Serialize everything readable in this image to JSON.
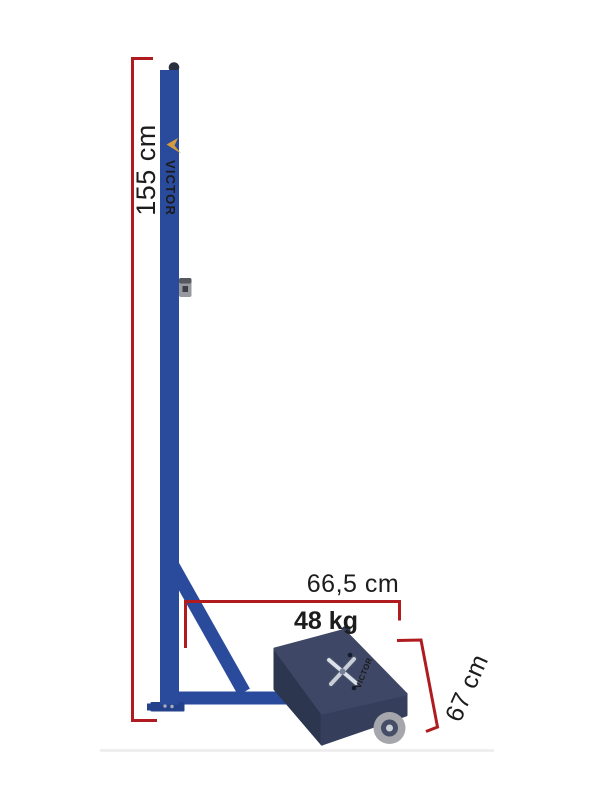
{
  "dimensions": {
    "height_label": "155 cm",
    "width_label": "66,5 cm",
    "weight_label": "48 kg",
    "depth_label": "67 cm"
  },
  "brand": {
    "post_label": "VICTOR",
    "base_label": "VICTOR"
  },
  "colors": {
    "dimension_red": "#AF1B1F",
    "text_black": "#1C1C1C",
    "frame_blue": "#2A4A9C",
    "frame_blue_dark": "#24418C",
    "block_navy_top": "#3E4765",
    "block_navy_left": "#2C364F",
    "block_navy_right": "#353F5C",
    "brand_gold": "#D49C3C",
    "wheel_grey": "#A6A7AD",
    "wheel_hub": "#454E66",
    "floor_grey": "#ECECEC"
  }
}
